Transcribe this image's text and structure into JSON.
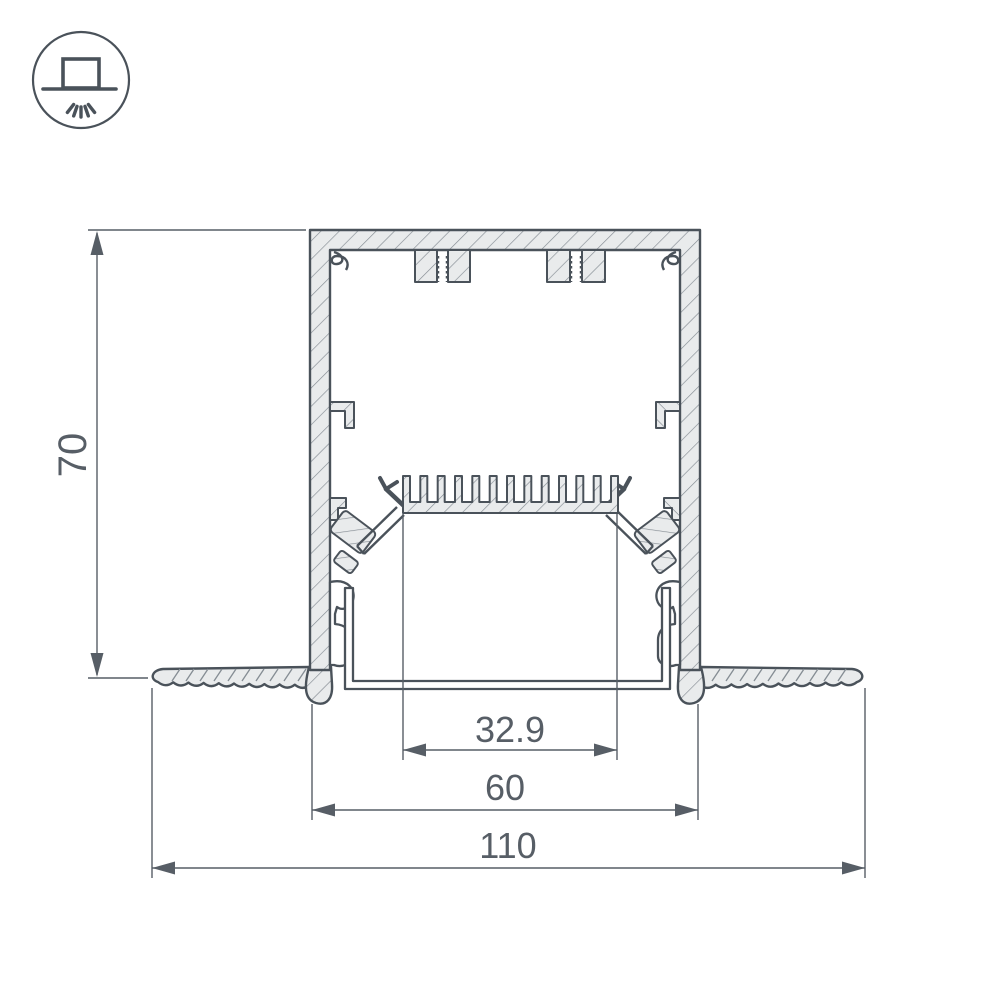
{
  "drawing": {
    "title": "recessed-led-profile-cross-section",
    "dimensions": {
      "height": "70",
      "led_window": "32.9",
      "body_width": "60",
      "overall_width": "110"
    },
    "icon": "recessed-mount-light-icon"
  },
  "colors": {
    "line": "#4a525a",
    "dim": "#575e66",
    "fill": "#e9ebec",
    "hatch": "#848c93",
    "background": "#ffffff"
  }
}
